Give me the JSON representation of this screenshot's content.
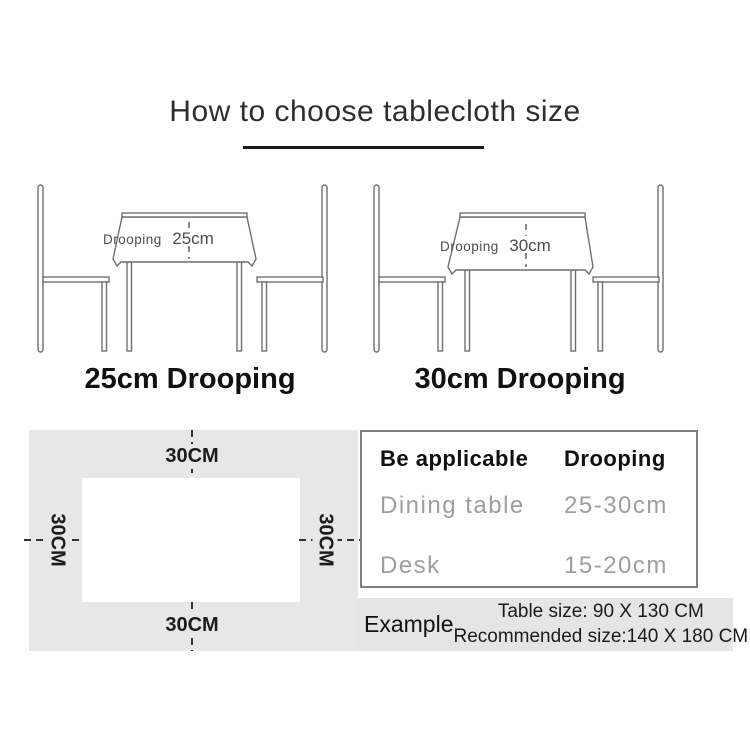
{
  "title": "How to choose tablecloth size",
  "illustrations": [
    {
      "drooping_label": "Drooping",
      "drooping_value": "25cm",
      "caption": "25cm Drooping"
    },
    {
      "drooping_label": "Drooping",
      "drooping_value": "30cm",
      "caption": "30cm Drooping"
    }
  ],
  "size_diagram": {
    "top": "30CM",
    "bottom": "30CM",
    "left": "30CM",
    "right": "30CM"
  },
  "spec_table": {
    "header": {
      "col1": "Be applicable",
      "col2": "Drooping"
    },
    "rows": [
      {
        "col1": "Dining table",
        "col2": "25-30cm"
      },
      {
        "col1": "Desk",
        "col2": "15-20cm"
      }
    ]
  },
  "example": {
    "label": "Example",
    "table_size": "Table size:  90 X 130 CM",
    "recommended_size": "Recommended size:140 X 180 CM"
  },
  "colors": {
    "heading_text": "#2e2e2e",
    "caption_text": "#111111",
    "muted_row_text": "#9e9e9e",
    "line_art": "#6f6f6f",
    "panel_gray": "#e7e7e7",
    "table_border": "#7e7e7e",
    "dash": "#333333"
  }
}
